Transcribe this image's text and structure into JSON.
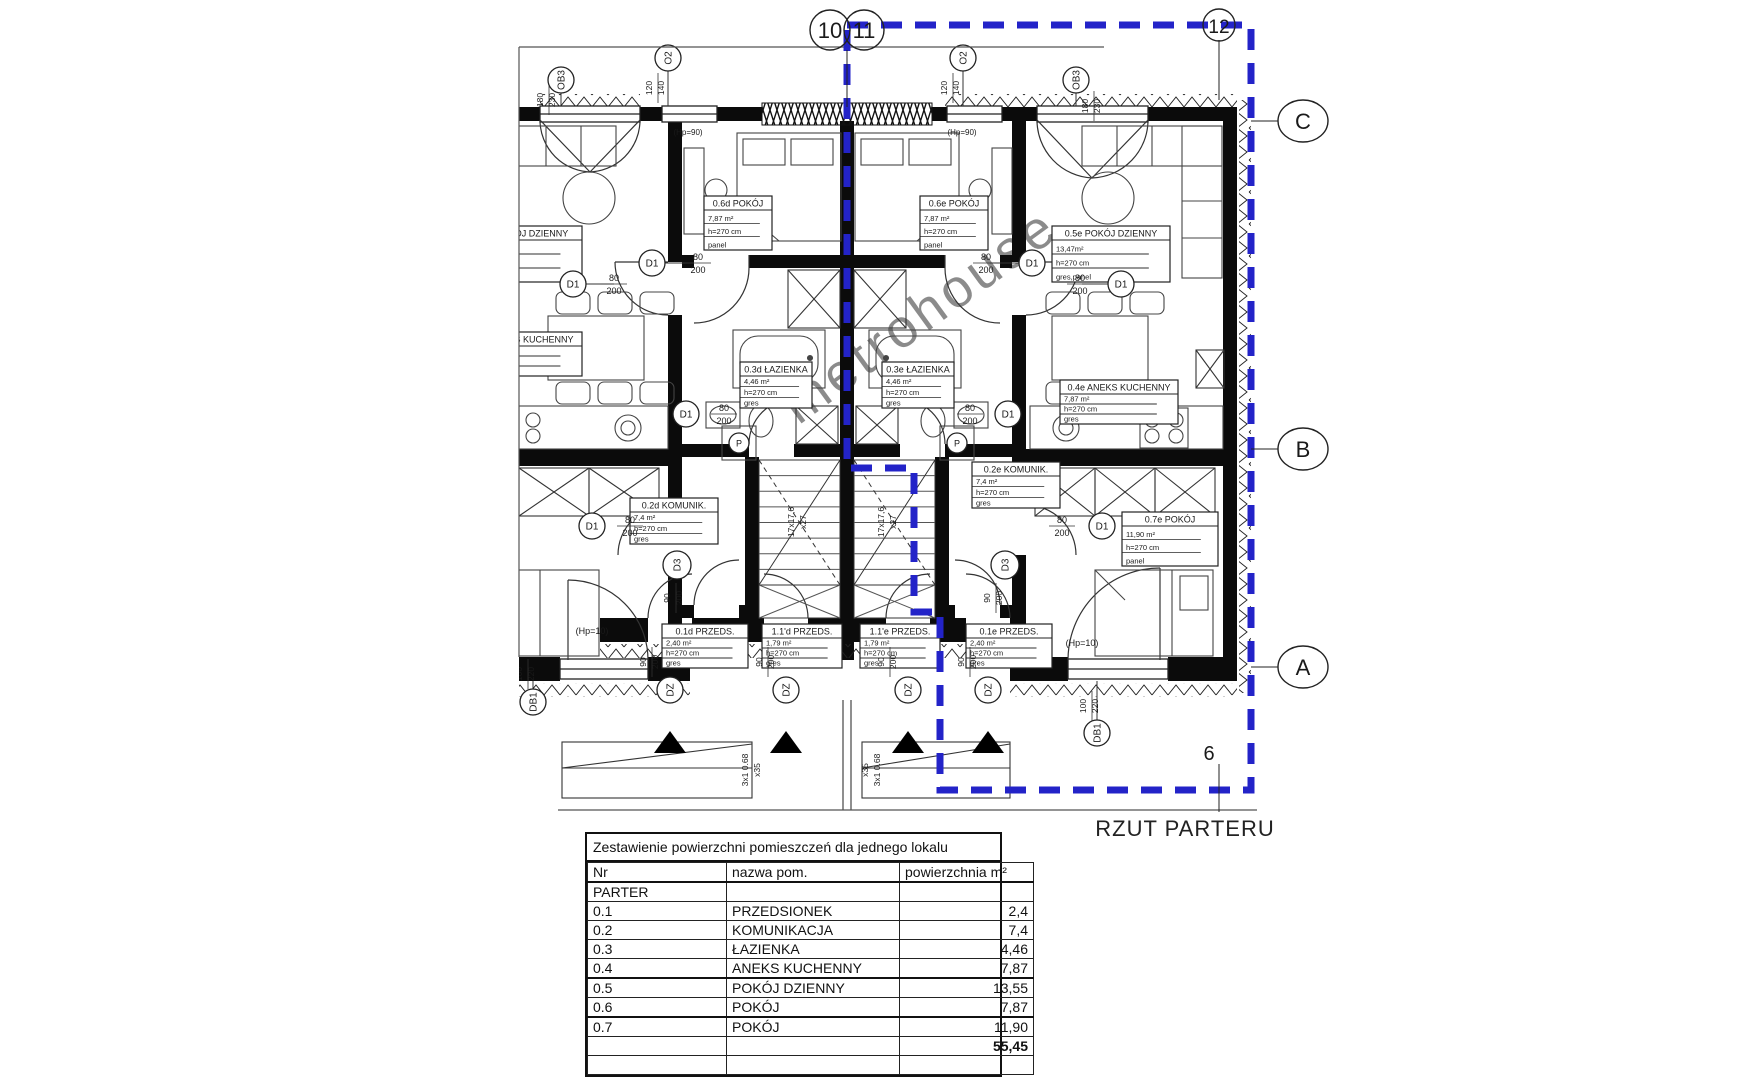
{
  "plan": {
    "caption": "RZUT PARTERU",
    "watermark": "metrohouse",
    "axes": {
      "g10": "10",
      "g11": "11",
      "g12": "12",
      "c": "C",
      "b": "B",
      "a": "A",
      "n6": "6"
    },
    "markers": {
      "d1": "D1",
      "d3": "D3",
      "dz": "DZ",
      "db1": "DB1",
      "o2": "O2",
      "ob3": "OB3",
      "p": "P",
      "gaz": "GAZ"
    },
    "dims": {
      "w80": "80",
      "h200": "200",
      "w90": "90",
      "w100": "100",
      "h220": "220",
      "w120": "120",
      "h140": "140",
      "w180": "180",
      "h230": "230",
      "hp90": "(Hp=90)",
      "hp10": "(Hp=10)",
      "stairs1": "17x17,6",
      "stairs2": "x27",
      "porch1": "3x1 0.68",
      "porch2": "x35"
    },
    "room_labels": [
      {
        "title": "0.6d POKÓJ",
        "rows": [
          "7,87 m²",
          "h=270 cm",
          "panel"
        ]
      },
      {
        "title": "0.6e POKÓJ",
        "rows": [
          "7,87 m²",
          "h=270 cm",
          "panel"
        ]
      },
      {
        "title": "0.5e POKÓJ DZIENNY",
        "rows": [
          "13,47m²",
          "h=270 cm",
          "gres,panel"
        ]
      },
      {
        "title": "0.4e ANEKS KUCHENNY",
        "rows": [
          "7,87 m²",
          "h=270 cm",
          "gres"
        ]
      },
      {
        "title": "0.3d ŁAZIENKA",
        "rows": [
          "4,46 m²",
          "h=270 cm",
          "gres"
        ]
      },
      {
        "title": "0.3e ŁAZIENKA",
        "rows": [
          "4,46 m²",
          "h=270 cm",
          "gres"
        ]
      },
      {
        "title": "0.2d KOMUNIK.",
        "rows": [
          "7,4 m²",
          "h=270 cm",
          "gres"
        ]
      },
      {
        "title": "0.2e KOMUNIK.",
        "rows": [
          "7,4 m²",
          "h=270 cm",
          "gres"
        ]
      },
      {
        "title": "0.7e POKÓJ",
        "rows": [
          "11,90 m²",
          "h=270 cm",
          "panel"
        ]
      },
      {
        "title": "0.1d PRZEDS.",
        "rows": [
          "2,40 m²",
          "h=270 cm",
          "gres"
        ]
      },
      {
        "title": "1.1'd PRZEDS.",
        "rows": [
          "1,79 m²",
          "h=270 cm",
          "gres"
        ]
      },
      {
        "title": "1.1'e PRZEDS.",
        "rows": [
          "1,79 m²",
          "h=270 cm",
          "gres"
        ]
      },
      {
        "title": "0.1e PRZEDS.",
        "rows": [
          "2,40 m²",
          "h=270 cm",
          "gres"
        ]
      },
      {
        "title": "0.5d POKÓJ DZIENNY",
        "rows": [
          "13,47m²",
          "h=270 cm",
          "gres,panel"
        ]
      },
      {
        "title": "0.4d ANEKS KUCHENNY",
        "rows": [
          "7,87 m²",
          "h=270 cm",
          "gres"
        ]
      }
    ]
  },
  "table": {
    "title": "Zestawienie powierzchni pomieszczeń dla jednego lokalu",
    "columns": [
      "Nr",
      "nazwa pom.",
      "powierzchnia m²"
    ],
    "section": "PARTER",
    "rows": [
      [
        "0.1",
        "PRZEDSIONEK",
        "2,4"
      ],
      [
        "0.2",
        "KOMUNIKACJA",
        "7,4"
      ],
      [
        "0.3",
        "ŁAZIENKA",
        "4,46"
      ],
      [
        "0.4",
        "ANEKS KUCHENNY",
        "7,87"
      ],
      [
        "0.5",
        "POKÓJ DZIENNY",
        "13,55"
      ],
      [
        "0.6",
        "POKÓJ",
        "7,87"
      ],
      [
        "0.7",
        "POKÓJ",
        "11,90"
      ]
    ],
    "total": "55,45"
  }
}
